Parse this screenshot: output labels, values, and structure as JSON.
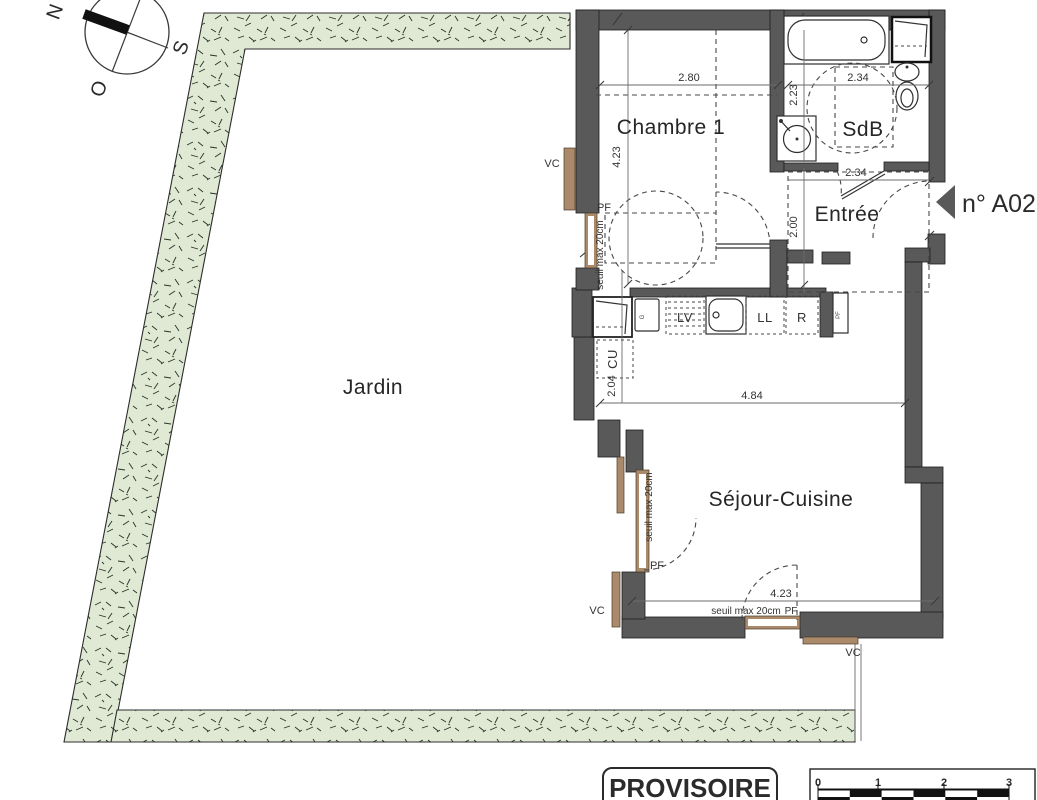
{
  "plan": {
    "title_note": "floor plan drawing",
    "compass": {
      "n": "N",
      "s": "S",
      "o": "O"
    },
    "rooms": {
      "jardin": "Jardin",
      "chambre": "Chambre 1",
      "sdb": "SdB",
      "entree": "Entrée",
      "sejour": "Séjour-Cuisine"
    },
    "unit": "n° A02",
    "dims": {
      "chambre_w": "2.80",
      "chambre_h": "4.23",
      "sdb_w": "2.34",
      "sdb_h": "2.23",
      "entree_w": "2.34",
      "entree_h": "2.00",
      "kitchen_w": "4.84",
      "kitchen_h": "2.04",
      "sejour_w": "4.23"
    },
    "ann": {
      "vc": "VC",
      "pf": "PF",
      "cu": "CU",
      "lv": "LV",
      "ll": "LL",
      "r": "R",
      "g": "G",
      "seuil": "seuil max 20cm"
    },
    "stamp": "PROVISOIRE",
    "scalebar": [
      "0",
      "1",
      "2",
      "3"
    ],
    "colors": {
      "wall": "#59595a",
      "garden": "#dfe9d4",
      "window": "#aa8a6a",
      "line": "#333333"
    }
  }
}
